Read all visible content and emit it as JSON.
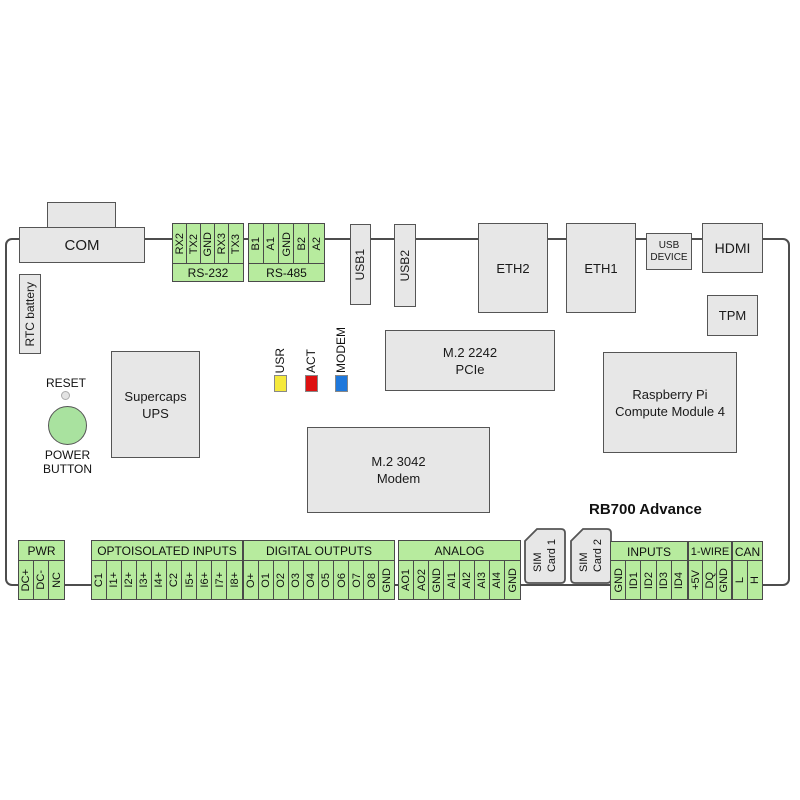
{
  "board": {
    "name": "RB700 Advance"
  },
  "colors": {
    "connector_green": "#b7eb9e",
    "component_gray": "#e7e7e7",
    "outline_gray": "#4d4d4d",
    "power_button_green": "#a9e29f",
    "led_usr": "#f5e93c",
    "led_act": "#dd1111",
    "led_modem": "#1e78dc"
  },
  "top": {
    "com": "COM",
    "rtc_battery": "RTC battery",
    "rs232": {
      "label": "RS-232",
      "pins": [
        "RX2",
        "TX2",
        "GND",
        "RX3",
        "TX3"
      ]
    },
    "rs485": {
      "label": "RS-485",
      "pins": [
        "B1",
        "A1",
        "GND",
        "B2",
        "A2"
      ]
    },
    "usb1": "USB1",
    "usb2": "USB2",
    "eth2": "ETH2",
    "eth1": "ETH1",
    "usb_device": "USB\nDEVICE",
    "hdmi": "HDMI",
    "tpm": "TPM"
  },
  "middle": {
    "supercaps": "Supercaps\nUPS",
    "reset": "RESET",
    "power_button": "POWER\nBUTTON",
    "leds": [
      {
        "label": "USR",
        "color": "#f5e93c"
      },
      {
        "label": "ACT",
        "color": "#dd1111"
      },
      {
        "label": "MODEM",
        "color": "#1e78dc"
      }
    ],
    "m2_2242": "M.2 2242\nPCIe",
    "m2_3042": "M.2 3042\nModem",
    "cm4": "Raspberry Pi\nCompute Module 4"
  },
  "bottom": {
    "pwr": {
      "label": "PWR",
      "pins": [
        "DC+",
        "DC-",
        "NC"
      ]
    },
    "opto": {
      "label": "OPTOISOLATED INPUTS",
      "pins": [
        "C1",
        "I1+",
        "I2+",
        "I3+",
        "I4+",
        "C2",
        "I5+",
        "I6+",
        "I7+",
        "I8+"
      ]
    },
    "digital": {
      "label": "DIGITAL OUTPUTS",
      "pins": [
        "O+",
        "O1",
        "O2",
        "O3",
        "O4",
        "O5",
        "O6",
        "O7",
        "O8",
        "GND"
      ]
    },
    "analog": {
      "label": "ANALOG",
      "pins": [
        "AO1",
        "AO2",
        "GND",
        "AI1",
        "AI2",
        "AI3",
        "AI4",
        "GND"
      ]
    },
    "sim1": "SIM\nCard 1",
    "sim2": "SIM\nCard 2",
    "inputs": {
      "label": "INPUTS",
      "pins": [
        "GND",
        "ID1",
        "ID2",
        "ID3",
        "ID4"
      ]
    },
    "onewire": {
      "label": "1-WIRE",
      "pins": [
        "+5V",
        "DQ",
        "GND"
      ]
    },
    "can": {
      "label": "CAN",
      "pins": [
        "L",
        "H"
      ]
    }
  }
}
